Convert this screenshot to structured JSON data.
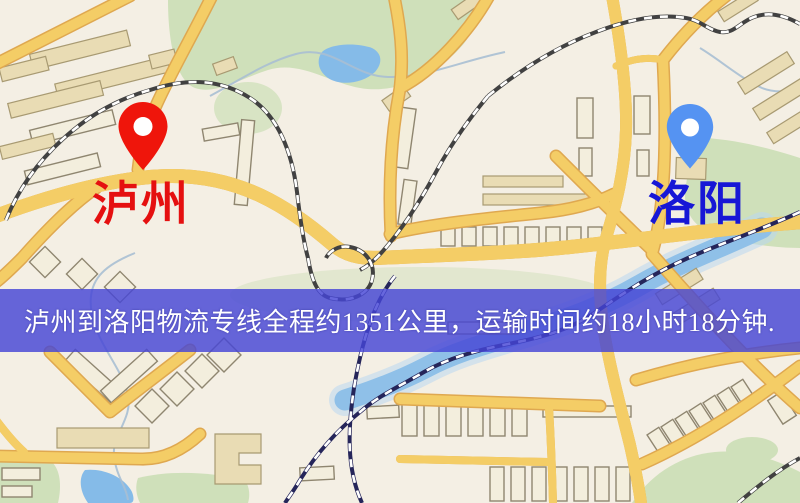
{
  "page": {
    "width": 800,
    "height": 503,
    "kind": "logistics-route-map"
  },
  "banner": {
    "text": "泸州到洛阳物流专线全程约1351公里，运输时间约18小时18分钟.",
    "background": "#4646d6",
    "text_color": "#ffffff"
  },
  "route": {
    "origin": "泸州",
    "destination": "洛阳",
    "distance_text": "约1351公里",
    "duration_text": "约18小时18分钟"
  },
  "markers": {
    "origin": {
      "name": "泸州",
      "pin_color": "#ef150b",
      "label_color": "#e51010"
    },
    "destination": {
      "name": "洛阳",
      "pin_color": "#5593f2",
      "label_color": "#1717d6"
    }
  },
  "map": {
    "colors": {
      "land": "#f4efe4",
      "park": "#cfe0ba",
      "water": "#85bbe8",
      "road": "#f4cd66",
      "road_casing": "#dfa850",
      "building": "#e9dcb4",
      "railway": "#414141"
    }
  }
}
